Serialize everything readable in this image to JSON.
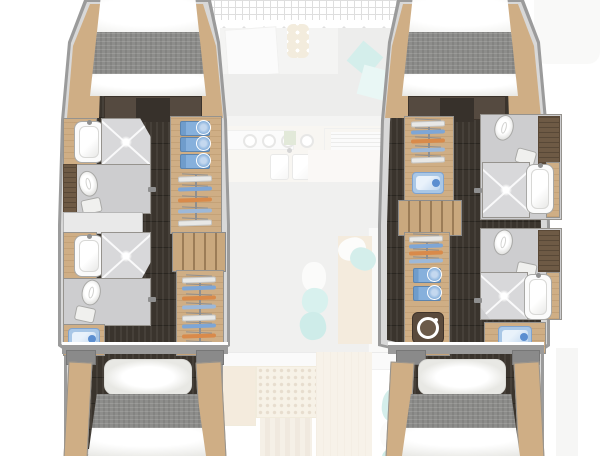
{
  "meta": {
    "title": "Catamaran lower-deck floor plan, 4 cabins / 4 heads",
    "view": "top-down",
    "visible_text": "none"
  },
  "colors": {
    "background": "#ffffff",
    "hull_outline": "#9b9b9b",
    "side_deck": "#d8d8d8",
    "cabin_sole_dark": "#3a342d",
    "joinery_wood": "#cfae85",
    "dark_joinery": "#6e5a45",
    "head_floor": "#cdcdcf",
    "fixture_white": "#fafafa",
    "towel_blue": "#7ea6d6",
    "hanger_orange": "#d98a4a",
    "accent_teal": "#8fd4cb",
    "blanket_gray": "#8d8d8b",
    "ghost_deck_opacity": 0.38
  },
  "deck_ghost": {
    "areas": [
      "trampoline",
      "forward-cockpit",
      "galley",
      "salon",
      "aft-cockpit"
    ],
    "galley": {
      "burners": 4,
      "sink_bowls": 2
    },
    "pillows_teal": 6
  },
  "port_hull": {
    "forward_cabin": {
      "bed": "island-double-berth"
    },
    "forward_head": {
      "fixtures": [
        "washbasin",
        "shower",
        "toilet"
      ]
    },
    "forward_storage": {
      "towels": 3,
      "hangers": 5
    },
    "companionway_steps": true,
    "aft_head": {
      "fixtures": [
        "washbasin",
        "shower",
        "toilet"
      ],
      "vanity_items": 1
    },
    "aft_wardrobe": {
      "hangers": 8
    },
    "aft_cabin": {
      "bed": "island-double-berth"
    }
  },
  "starboard_hull": {
    "forward_cabin": {
      "bed": "island-double-berth"
    },
    "forward_storage": {
      "hangers": 5,
      "drawer_items": 1
    },
    "companionway_steps": true,
    "forward_head": {
      "fixtures": [
        "toilet",
        "shower",
        "washbasin"
      ]
    },
    "aft_storage": {
      "hangers": 4,
      "towels": 2
    },
    "laundry": {
      "washing_machine": true
    },
    "aft_head": {
      "fixtures": [
        "toilet",
        "shower",
        "washbasin"
      ],
      "vanity_items": 1
    },
    "aft_cabin": {
      "bed": "island-double-berth"
    }
  }
}
